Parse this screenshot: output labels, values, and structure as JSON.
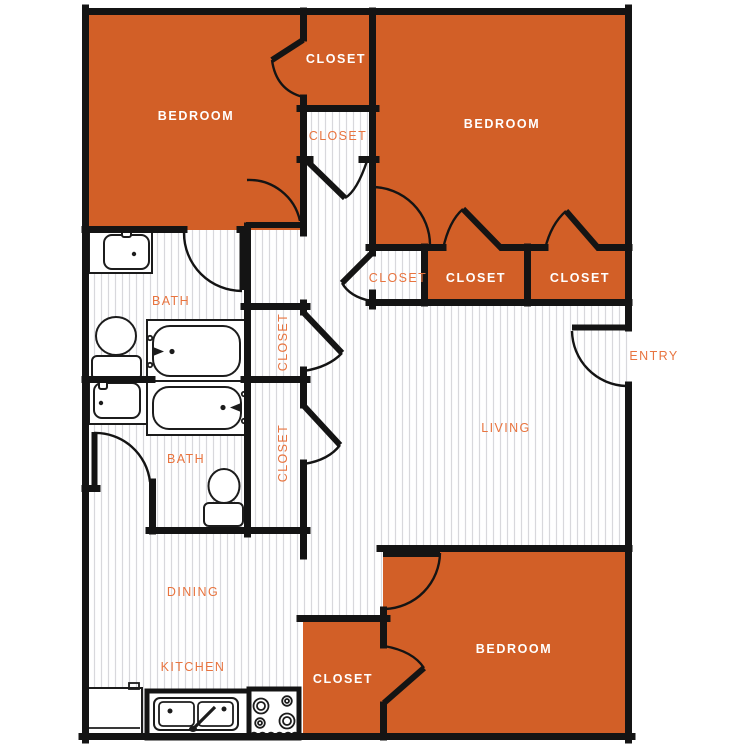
{
  "plan": {
    "title": "apartment-floor-plan",
    "colors": {
      "room_fill": "#d25f27",
      "label_orange": "#e8743f",
      "wall": "#141414",
      "hatch_line": "#d8d8dc",
      "background": "#ffffff"
    },
    "labels": {
      "bedroom1": "BEDROOM",
      "bedroom2": "BEDROOM",
      "bedroom3": "BEDROOM",
      "closet_top": "CLOSET",
      "closet_hall": "CLOSET",
      "closet_row_white": "CLOSET",
      "closet_row_1": "CLOSET",
      "closet_row_2": "CLOSET",
      "closet_a": "CLOSET",
      "closet_b": "CLOSET",
      "closet_3": "CLOSET",
      "bath_1": "BATH",
      "bath_2": "BATH",
      "living": "LIVING",
      "entry": "ENTRY",
      "dining": "DINING",
      "kitchen": "KITCHEN"
    }
  }
}
